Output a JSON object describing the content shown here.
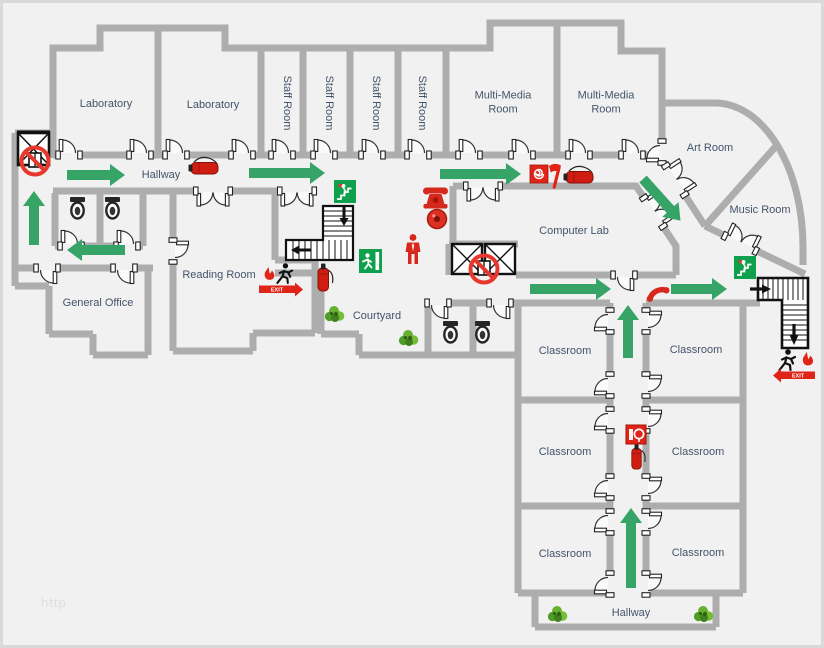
{
  "watermark": "http",
  "signs": {
    "exit_label": "EXIT"
  },
  "rooms": {
    "laboratory_1": "Laboratory",
    "laboratory_2": "Laboratory",
    "staff_room_1": "Staff Room",
    "staff_room_2": "Staff Room",
    "staff_room_3": "Staff Room",
    "staff_room_4": "Staff Room",
    "multi_media_room_1": "Multi-Media Room",
    "multi_media_room_2": "Multi-Media Room",
    "art_room": "Art Room",
    "music_room": "Music Room",
    "computer_lab": "Computer Lab",
    "reading_room": "Reading Room",
    "general_office": "General Office",
    "courtyard": "Courtyard",
    "hallway_top": "Hallway",
    "hallway_bottom": "Hallway",
    "classroom_1": "Classroom",
    "classroom_2": "Classroom",
    "classroom_3": "Classroom",
    "classroom_4": "Classroom",
    "classroom_5": "Classroom",
    "classroom_6": "Classroom"
  },
  "colors": {
    "background": "#f1f1f1",
    "wall": "#adadad",
    "route_arrow_green": "#35a466",
    "exit_sign_green": "#0ea04c",
    "alarm_red": "#e02417",
    "fixture_black": "#111111",
    "label_text": "#44546a",
    "watermark_gray": "#dedede"
  },
  "icons": {
    "elevator": "square-with-x",
    "no_elevator": "red-circle-slash",
    "door": "quarter-arc-swing",
    "double_door": "double-quarter-arc",
    "stairs": "l-shaped-treads-with-arrows",
    "exit_sign_stairs": "green-square-person-descending-stairs",
    "exit_sign_running_man": "green-square-running-man-door",
    "emergency_exit_badge": "runner-flame-red-exit-arrow",
    "fire_extinguisher": "red-cylinder-with-hose",
    "fire_hose_cabinet": "red-box-with-hose-coil",
    "fire_alarm_bell": "red-bell-dome",
    "fire_alarm_call_point": "red-square-white-spiral",
    "fire_axe": "red-axe",
    "emergency_phone": "red-telephone",
    "phone_handset": "red-handset",
    "evacuee_person": "red-person-silhouette",
    "toilet": "toilet-fixture",
    "plant": "green-shrub",
    "route_arrow": "green-evacuation-arrow"
  }
}
